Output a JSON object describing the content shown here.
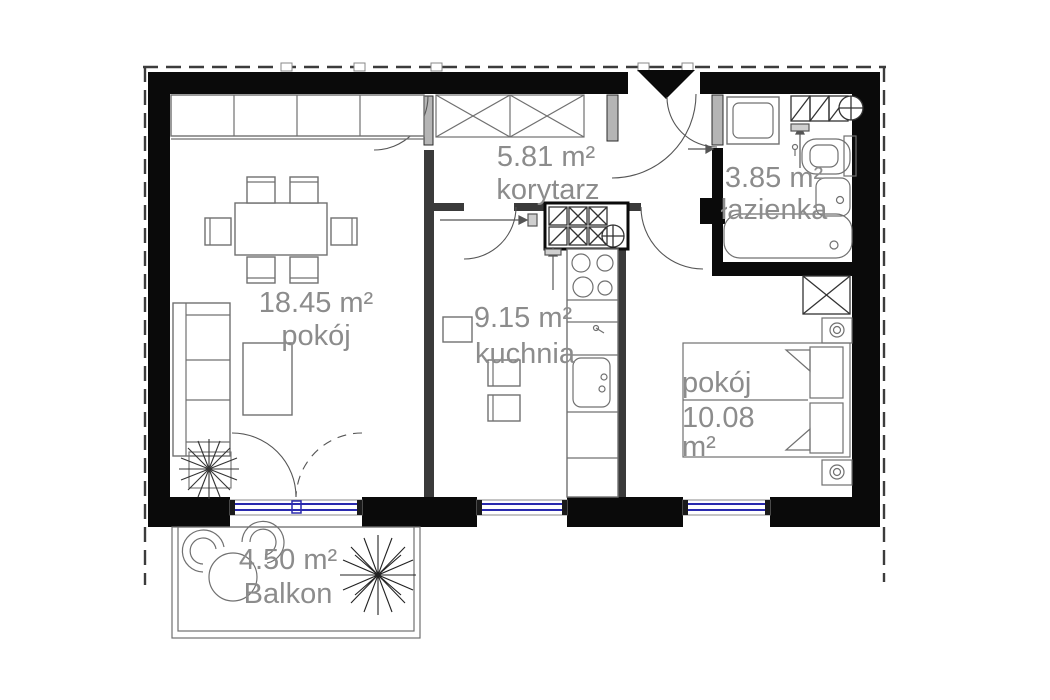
{
  "plan": {
    "type": "apartment-floor-plan",
    "colors": {
      "wall": "#0a0a0a",
      "glazing": "#2a2aae",
      "label": "#8c8c8c",
      "furniture_line": "#707070",
      "boundary_dash": "#3c3c3c"
    },
    "rooms": [
      {
        "key": "living-room",
        "name": "pokój",
        "area": "18.45 m²"
      },
      {
        "key": "kitchen",
        "name": "kuchnia",
        "area": "9.15 m²"
      },
      {
        "key": "corridor",
        "name": "korytarz",
        "area": "5.81 m²"
      },
      {
        "key": "bathroom",
        "name": "łazienka",
        "area": "3.85 m²"
      },
      {
        "key": "bedroom",
        "name": "pokój",
        "area_value": "10.08",
        "area_unit": "m²"
      },
      {
        "key": "balcony",
        "name": "Balkon",
        "area": "4.50 m²"
      }
    ]
  }
}
